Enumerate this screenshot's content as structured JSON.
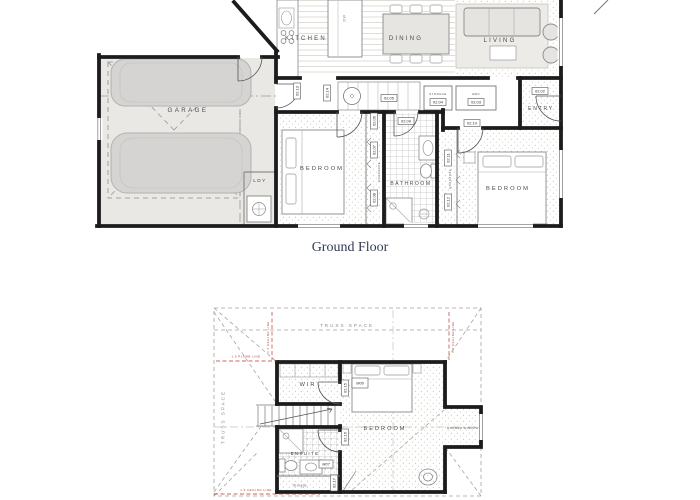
{
  "caption": "Ground Floor",
  "colors": {
    "wall": "#1c1c1c",
    "annotation_red": "#b03a2e",
    "caption_text": "#2f3a52",
    "car_fill": "#d5d4d2"
  },
  "gf": {
    "labels": {
      "kitchen": "KITCHEN",
      "dining": "DINING",
      "living": "LIVING",
      "entry": "ENTRY",
      "garage": "GARAGE",
      "laundry": "LDY",
      "bedroom_left": "BEDROOM",
      "bathroom": "BATHROOM",
      "bedroom_right": "BEDROOM",
      "storage_closet": "STORAGE",
      "hwc_closet": "HWC",
      "wardrobe": "WARDROBE",
      "dishwasher": "DW"
    },
    "tags": {
      "d02": "02.02",
      "d03": "02.03",
      "d04": "02.04",
      "d05": "02.05",
      "d06": "02.06",
      "d07": "02.07",
      "d08": "02.08",
      "d09": "02.09",
      "d10": "02.10",
      "d11": "02.11",
      "d12": "02.12",
      "d13": "02.13",
      "d14": "02.14"
    }
  },
  "ff": {
    "labels": {
      "truss_space_top": "TRUSS SPACE",
      "truss_space_left": "TRUSS SPACE",
      "wir": "WIR",
      "bedroom": "BEDROOM",
      "ensuite": "ENSUITE",
      "storage": "Storage",
      "dormer_window": "DORMER WINDOW"
    },
    "tags": {
      "m06": "M06",
      "m07": "M07",
      "d15": "02.15",
      "d16": "02.16",
      "d17": "02.17"
    },
    "annotations": {
      "plumb_line": "1.5 PLUMB LINE",
      "ceiling_line_left": "1.5 CEILING LINE",
      "ceiling_line_right": "1.5 CEILING LINE",
      "ceiling_line_bottom": "1.5 CEILING LINE"
    }
  }
}
